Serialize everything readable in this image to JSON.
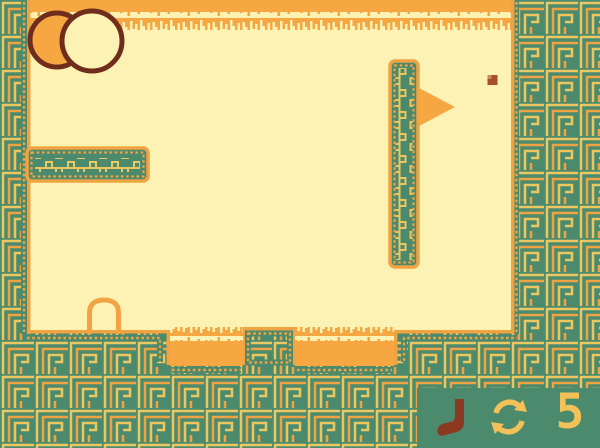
{
  "hud": {
    "stroke_count": "5",
    "icons": [
      {
        "name": "golf-club-icon"
      },
      {
        "name": "restart-icon"
      }
    ]
  },
  "level": {
    "objects": {
      "decoration": "overlapping-circles",
      "flag": "flag-pennant",
      "ball": "golf-ball",
      "cup": "cup-arch",
      "platform": "left-platform",
      "wall": "flag-wall"
    }
  },
  "colors": {
    "teal": "#4c8a6e",
    "cream": "#fcf2b4",
    "orange": "#f6a742",
    "orange_line": "#f0a342",
    "gold_line": "#ecc75f",
    "dark_brown": "#6f2e1b",
    "club_brown": "#8b3a21",
    "ball_brown": "#a74d2c",
    "hud_gold": "#f2c157"
  }
}
